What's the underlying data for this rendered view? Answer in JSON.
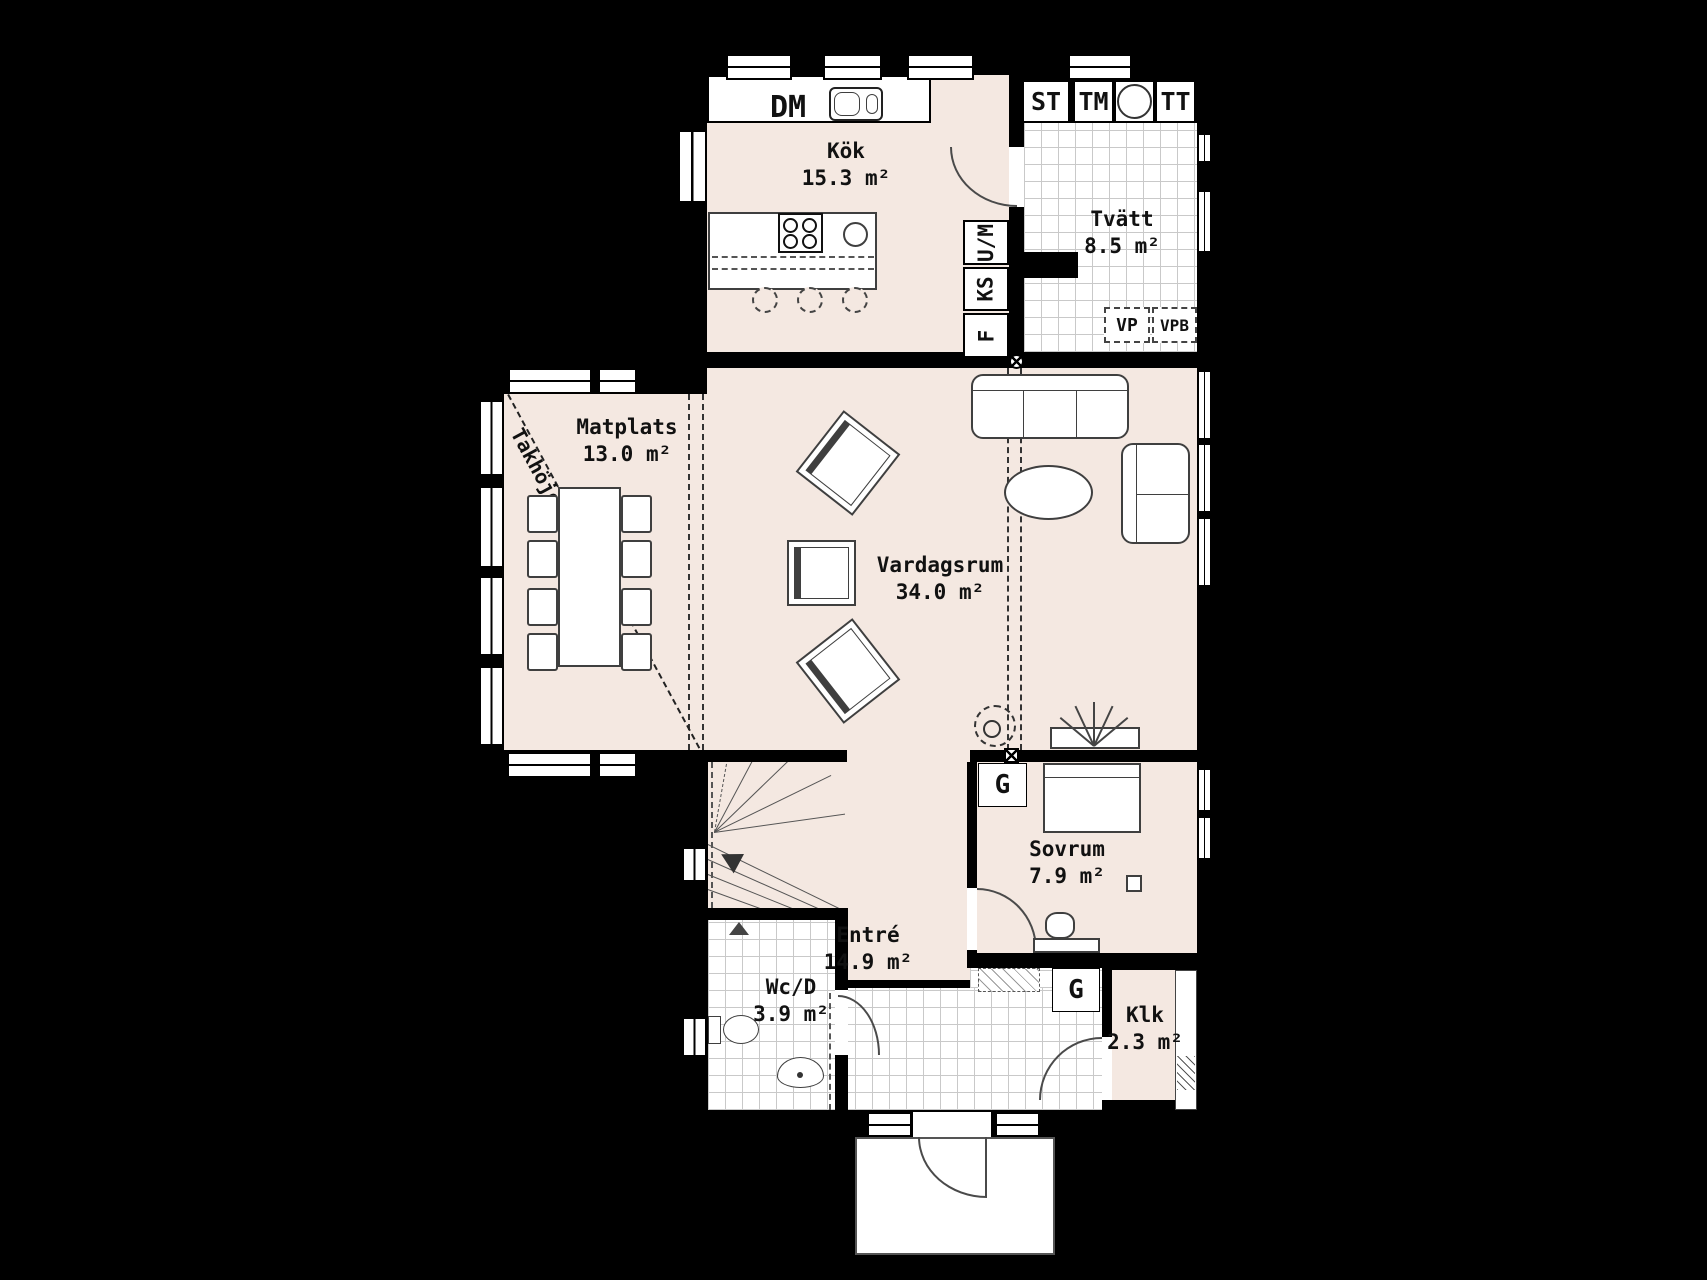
{
  "plan_title": "floor-plan",
  "rooms": [
    {
      "name": "Kök",
      "area": "15.3 m²"
    },
    {
      "name": "Tvätt",
      "area": "8.5 m²"
    },
    {
      "name": "Matplats",
      "area": "13.0 m²"
    },
    {
      "name": "Vardagsrum",
      "area": "34.0 m²"
    },
    {
      "name": "Sovrum",
      "area": "7.9 m²"
    },
    {
      "name": "Wc/D",
      "area": "3.9 m²"
    },
    {
      "name": "Entré",
      "area": "14.9 m²"
    },
    {
      "name": "Klk",
      "area": "2.3 m²"
    }
  ],
  "appliances": {
    "dm": "DM",
    "st": "ST",
    "tm": "TM",
    "tt": "TT",
    "um": "U/M",
    "ks": "KS",
    "f": "F",
    "vp": "VP",
    "vpb": "VPB"
  },
  "wardrobe": "G",
  "annotations": {
    "ceiling_height": "Takhöjd=2.33m"
  },
  "colors": {
    "floor": "#f4e8e1",
    "wall": "#000000",
    "tile_floor": "#ffffff",
    "tile_line": "#c9c9c9",
    "furniture_outline": "#3f3f3f"
  }
}
